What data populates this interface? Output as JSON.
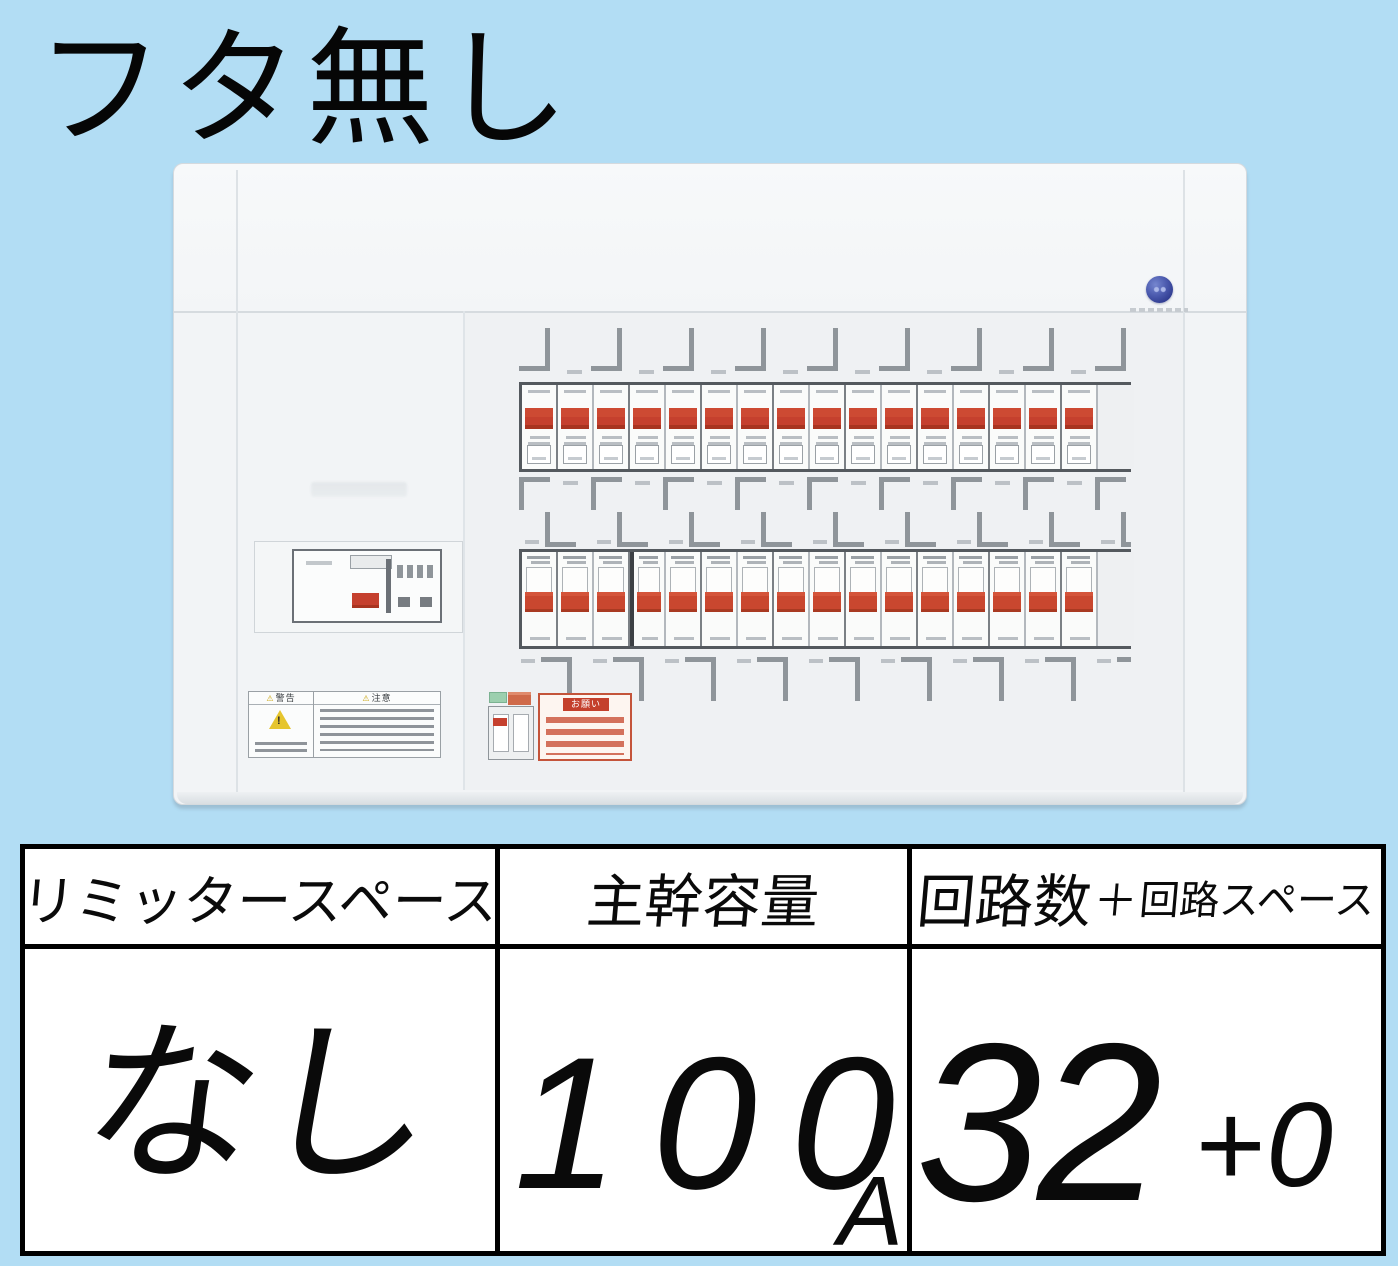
{
  "title": "フタ無し",
  "colors": {
    "background": "#b2ddf4",
    "panel": "#f2f4f6",
    "breaker_red": "#c5402e",
    "logo_blue": "#3a4da0",
    "table_border": "#000000",
    "warning_yellow": "#e6c52e"
  },
  "panel": {
    "breaker_rows": [
      {
        "count": 16
      },
      {
        "count": 16
      }
    ],
    "warning_label": {
      "left_header": "警告",
      "right_header": "注意"
    },
    "notice_label": {
      "title": "お願い"
    }
  },
  "table": {
    "headers": {
      "col1": "リミッタースペース",
      "col2": "主幹容量",
      "col3_main": "回路数",
      "col3_plus": "＋",
      "col3_sub": "回路スペース"
    },
    "values": {
      "limiter": "なし",
      "capacity_digits": [
        "1",
        "0",
        "0"
      ],
      "capacity_unit": "A",
      "circuits": "32",
      "circuits_extra": "+0"
    }
  }
}
